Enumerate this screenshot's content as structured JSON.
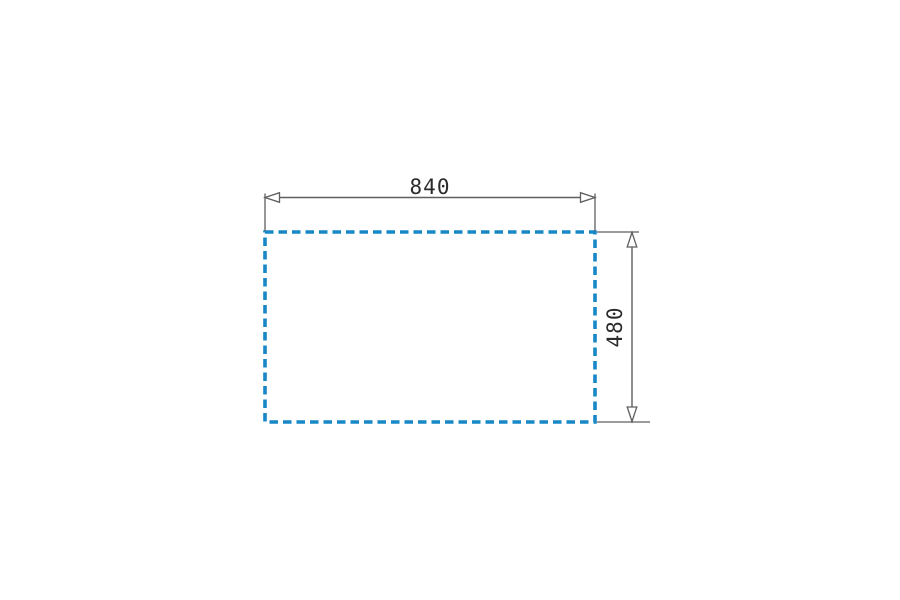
{
  "diagram": {
    "type": "technical-dimension-drawing",
    "shape": "dashed-rectangle-cutout-outline",
    "dimensions": {
      "width": {
        "label": "840",
        "value": 840
      },
      "height": {
        "label": "480",
        "value": 480
      }
    }
  },
  "colors": {
    "outline_blue": "#1787c6",
    "dimension_gray": "#5f5f5f",
    "text_dark": "#2b2b2b",
    "arrow_fill": "#ffffff",
    "background": "#ffffff"
  }
}
